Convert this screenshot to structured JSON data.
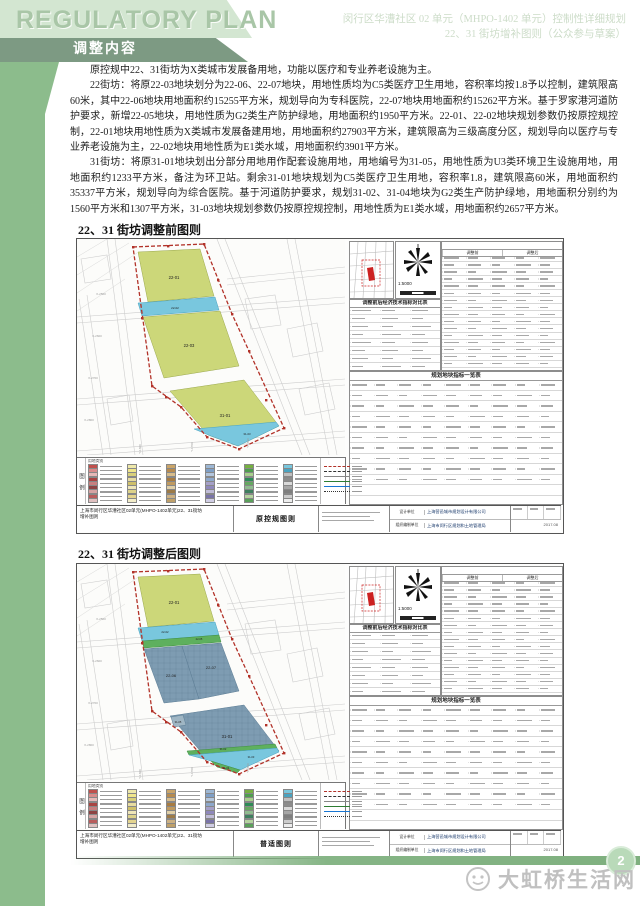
{
  "header": {
    "title_en": "REGULATORY PLAN",
    "line1": "闵行区华漕社区 02 单元（MHPO-1402 单元）控制性详细规划",
    "line2": "22、31 街坊增补图则（公众参与草案）",
    "banner": "调整内容"
  },
  "body": {
    "para1": "原控规中22、31街坊为X类城市发展备用地，功能以医疗和专业养老设施为主。",
    "para2": "22街坊：将原22-03地块划分为22-06、22-07地块，用地性质均为C5类医疗卫生用地，容积率均按1.8予以控制，建筑限高60米，其中22-06地块用地面积约15255平方米，规划导向为专科医院，22-07地块用地面积约15262平方米。基于罗家港河道防护要求，新增22-05地块，用地性质为G2类生产防护绿地，用地面积约1950平方米。22-01、22-02地块规划参数仍按原控规控制，22-01地块用地性质为X类城市发展备建用地，用地面积约27903平方米，建筑限高为三级高度分区，规划导向以医疗与专业养老设施为主，22-02地块用地性质为E1类水域，用地面积约3901平方米。",
    "para3": "31街坊：将原31-01地块划出分部分用地用作配套设施用地，用地编号为31-05，用地性质为U3类环境卫生设施用地，用地面积约1233平方米，备注为环卫站。剩余31-01地块规划为C5类医疗卫生用地，容积率1.8，建筑限高60米，用地面积约35337平方米，规划导向为综合医院。基于河道防护要求，规划31-02、31-04地块为G2类生产防护绿地，用地面积分别约为1560平方米和1307平方米，31-03地块规划参数仍按原控规控制，用地性质为E1类水域，用地面积约2657平方米。"
  },
  "headings": {
    "fig1": "22、31 街坊调整前图则",
    "fig2": "22、31 街坊调整后图则"
  },
  "figure_common": {
    "scale": "1:5000",
    "legend_title": "图例",
    "legend_header": "用地类别",
    "compare_table_title": "调整前后经济技术指标对比表",
    "group_before": "调整前",
    "group_after": "调整后",
    "index_table_title": "规划地块指标一览表",
    "project": "上海市闵行区华漕社区02单元(MHPO-1402单元)22、31街坊",
    "project_sub": "增补图则",
    "design_unit_label": "设计单位",
    "design_unit": "上海营邑城市规划设计有限公司",
    "org_unit_label": "组织编制单位",
    "org_unit": "上海市闵行区规划和土地管理局",
    "date": "2017.08"
  },
  "fig1": {
    "center_label": "原控规图则",
    "labels": [
      {
        "t": "22-01",
        "x": 97,
        "y": 40,
        "s": 4.2
      },
      {
        "t": "22-02",
        "x": 98,
        "y": 70,
        "s": 3
      },
      {
        "t": "22-03",
        "x": 112,
        "y": 108,
        "s": 4.2
      },
      {
        "t": "31-01",
        "x": 148,
        "y": 178,
        "s": 4.2
      },
      {
        "t": "31-03",
        "x": 170,
        "y": 196,
        "s": 2.8
      },
      {
        "t": "X-2500",
        "x": 24,
        "y": 56,
        "s": 3,
        "c": "#9a9a9a"
      },
      {
        "t": "X-2600",
        "x": 20,
        "y": 98,
        "s": 3,
        "c": "#9a9a9a"
      },
      {
        "t": "X-2700",
        "x": 16,
        "y": 140,
        "s": 3,
        "c": "#9a9a9a"
      },
      {
        "t": "X-2800",
        "x": 12,
        "y": 182,
        "s": 3,
        "c": "#9a9a9a"
      },
      {
        "t": "Y-1600",
        "x": 64,
        "y": 210,
        "s": 3,
        "c": "#9a9a9a",
        "r": -90
      },
      {
        "t": "Y-1700",
        "x": 116,
        "y": 208,
        "s": 3,
        "c": "#9a9a9a",
        "r": -90
      },
      {
        "t": "Y-1800",
        "x": 172,
        "y": 204,
        "s": 3,
        "c": "#9a9a9a",
        "r": -90
      }
    ]
  },
  "fig2": {
    "center_label": "普适图则",
    "labels": [
      {
        "t": "22-01",
        "x": 97,
        "y": 40,
        "s": 4.2
      },
      {
        "t": "22-02",
        "x": 88,
        "y": 69,
        "s": 2.8
      },
      {
        "t": "22-05",
        "x": 122,
        "y": 76,
        "s": 2.6
      },
      {
        "t": "22-06",
        "x": 94,
        "y": 113,
        "s": 4
      },
      {
        "t": "22-07",
        "x": 134,
        "y": 105,
        "s": 4
      },
      {
        "t": "31-01",
        "x": 150,
        "y": 174,
        "s": 4.2
      },
      {
        "t": "31-05",
        "x": 101,
        "y": 159,
        "s": 2.6
      },
      {
        "t": "31-02",
        "x": 146,
        "y": 186,
        "s": 2.6
      },
      {
        "t": "31-03",
        "x": 174,
        "y": 194,
        "s": 2.6
      },
      {
        "t": "31-04",
        "x": 149,
        "y": 205,
        "s": 2.6
      },
      {
        "t": "X-2500",
        "x": 24,
        "y": 56,
        "s": 3,
        "c": "#9a9a9a"
      },
      {
        "t": "X-2600",
        "x": 20,
        "y": 98,
        "s": 3,
        "c": "#9a9a9a"
      },
      {
        "t": "X-2700",
        "x": 16,
        "y": 140,
        "s": 3,
        "c": "#9a9a9a"
      },
      {
        "t": "X-2800",
        "x": 12,
        "y": 182,
        "s": 3,
        "c": "#9a9a9a"
      },
      {
        "t": "Y-1600",
        "x": 64,
        "y": 210,
        "s": 3,
        "c": "#9a9a9a",
        "r": -90
      },
      {
        "t": "Y-1700",
        "x": 116,
        "y": 208,
        "s": 3,
        "c": "#9a9a9a",
        "r": -90
      },
      {
        "t": "Y-1800",
        "x": 172,
        "y": 204,
        "s": 3,
        "c": "#9a9a9a",
        "r": -90
      }
    ]
  },
  "legend": {
    "columns": [
      [
        "#c0504d",
        "#d98b8b",
        "#e6b8b7",
        "#a94442",
        "#c87f7f",
        "#8e4444",
        "#d6a3a3",
        "#b95c5c",
        "#e0c0c0"
      ],
      [
        "#eee8aa",
        "#f0e68c",
        "#d9d07a",
        "#e8dca0",
        "#cfc06a",
        "#efe6b8",
        "#ddd28a",
        "#e4d48e",
        "#f2ecc8"
      ],
      [
        "#caa56a",
        "#b78b4f",
        "#d8bc8a",
        "#a87c42",
        "#c09a60",
        "#e0cfa8",
        "#9c7a48",
        "#cdb183",
        "#bfa06a"
      ],
      [
        "#9db7d4",
        "#7f9fc6",
        "#b3c6de",
        "#8ea8cc",
        "#a5a0c8",
        "#8f88bb",
        "#c0bcd8",
        "#7a74a8",
        "#d0cde4"
      ],
      [
        "#76b041",
        "#4f9e4f",
        "#a8d08d",
        "#2e8b57",
        "#66a861",
        "#8fbc8f",
        "#3f7f5f",
        "#b5d4a0",
        "#5aa05a"
      ],
      [
        "#79c7de",
        "#4aa3c0",
        "#bfbfbf",
        "#8c8c8c",
        "#d9d9d9",
        "#a6a6a6",
        "#7f7f7f",
        "#cccccc",
        "#ededed"
      ]
    ],
    "linetypes": [
      {
        "color": "#b23229",
        "style": "dashed"
      },
      {
        "color": "#333333",
        "style": "dashed"
      },
      {
        "color": "#888888",
        "style": "solid"
      },
      {
        "color": "#2e7d32",
        "style": "solid"
      },
      {
        "color": "#1976d2",
        "style": "solid"
      },
      {
        "color": "#333333",
        "style": "dotted"
      }
    ]
  },
  "footer": {
    "page_number": "2",
    "watermark": "大虹桥生活网"
  },
  "colors": {
    "accent_green": "#8cbc8c",
    "banner_green": "#7d9a83",
    "parcel_yellow": "#ccd779",
    "water_blue": "#79c7de",
    "medical_blue": "#7e9cb2",
    "buffer_green": "#5eb05e",
    "boundary_red": "#b23229"
  }
}
